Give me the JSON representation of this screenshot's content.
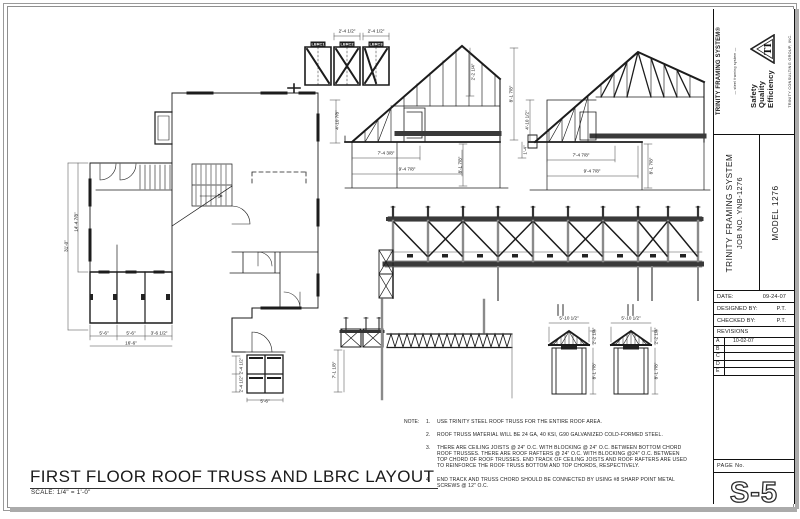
{
  "colors": {
    "line": "#1c1c1c",
    "frame_gray": "#9a9a9a",
    "post_gray": "#8a8a8a"
  },
  "sheet": {
    "title": "FIRST FLOOR ROOF TRUSS AND LBRC LAYOUT",
    "scale": "SCALE:  1/4\" =  1'-0\""
  },
  "title_block": {
    "brand": "TRINITY FRAMING SYSTEM®",
    "brand_tagline": "— steel framing system —",
    "values": [
      "Safety",
      "Quality",
      "Efficiency"
    ],
    "monogram": "TI",
    "company": "TRINITY CONSULTING GROUP, INC.",
    "project": {
      "line1": "TRINITY FRAMING SYSTEM",
      "line2": "JOB NO. YNB-1276",
      "model": "MODEL  1276"
    },
    "date_label": "DATE:",
    "date_value": "09-24-07",
    "designed_label": "DESIGNED BY:",
    "designed_value": "P.T.",
    "checked_label": "CHECKED BY:",
    "checked_value": "P.T.",
    "revisions_label": "REVISIONS",
    "revisions": [
      {
        "row": "A",
        "date": "10-02-07"
      },
      {
        "row": "B",
        "date": ""
      },
      {
        "row": "C",
        "date": ""
      },
      {
        "row": "D",
        "date": ""
      },
      {
        "row": "E",
        "date": ""
      }
    ],
    "page_label": "PAGE  No.",
    "page_number": "S-5"
  },
  "notes": {
    "heading": "NOTE:",
    "items": [
      {
        "num": "1.",
        "text": "USE TRINITY STEEL ROOF TRUSS FOR THE ENTIRE ROOF AREA."
      },
      {
        "num": "2.",
        "text": "ROOF TRUSS MATERIAL WILL BE 24 GA, 40 KSI, G90 GALVANIZED COLD-FORMED STEEL."
      },
      {
        "num": "3.",
        "text": "THERE ARE CEILING JOISTS @ 24\" O.C. WITH BLOCKING @ 24\" O.C. BETWEEN BOTTOM CHORD ROOF TRUSSES.  THERE ARE ROOF RAFTERS @ 24\" O.C. WITH BLOCKING @24\" O.C. BETWEEN TOP CHORD OF ROOF TRUSSES.  END TRACK OF CEILING JOISTS AND ROOF RAFTERS ARE USED TO REINFORCE THE ROOF TRUSS BOTTOM AND TOP CHORDS, RESPECTIVELY."
      },
      {
        "num": "4.",
        "text": "END TRACK AND TRUSS CHORD SHOULD BE CONNECTED BY USING #8 SHARP POINT METAL SCREWS @ 12\" O.C."
      }
    ]
  },
  "drawing": {
    "panel_labels": [
      "LBRC1",
      "LBRC2",
      "LBRC3"
    ],
    "labels": [
      {
        "t": "2'-4 1/2\"",
        "x": 347,
        "y": 31
      },
      {
        "t": "2'-4 1/2\"",
        "x": 376,
        "y": 31
      },
      {
        "t": "LBRC1",
        "x": 318,
        "y": 44,
        "inv": 1
      },
      {
        "t": "LBRC2",
        "x": 347,
        "y": 44,
        "inv": 1
      },
      {
        "t": "LBRC3",
        "x": 376,
        "y": 44,
        "inv": 1
      },
      {
        "t": "7'-4 3/8\"",
        "x": 386,
        "y": 153
      },
      {
        "t": "9'-4 7/8\"",
        "x": 407,
        "y": 169
      },
      {
        "t": "2'-2 1/4\"",
        "x": 473,
        "y": 72,
        "rot": 1
      },
      {
        "t": "8'-1 7/8\"",
        "x": 511,
        "y": 94,
        "rot": 1
      },
      {
        "t": "8'-1 7/8\"",
        "x": 460,
        "y": 165,
        "rot": 1
      },
      {
        "t": "7'-4 7/8\"",
        "x": 581,
        "y": 155
      },
      {
        "t": "9'-4 7/8\"",
        "x": 592,
        "y": 171
      },
      {
        "t": "8'-1 7/8\"",
        "x": 651,
        "y": 166,
        "rot": 1
      },
      {
        "t": "4'-10 1/2\"",
        "x": 527,
        "y": 120,
        "rot": 1
      },
      {
        "t": "1'-4\"",
        "x": 525,
        "y": 150,
        "rot": 1
      },
      {
        "t": "5'-10 1/2\"",
        "x": 569,
        "y": 318
      },
      {
        "t": "5'-10 1/2\"",
        "x": 631,
        "y": 318
      },
      {
        "t": "2'-2 1/4\"",
        "x": 594,
        "y": 336,
        "rot": 1
      },
      {
        "t": "8'-1 7/8\"",
        "x": 594,
        "y": 371,
        "rot": 1
      },
      {
        "t": "2'-2 1/4\"",
        "x": 656,
        "y": 336,
        "rot": 1
      },
      {
        "t": "8'-1 7/8\"",
        "x": 656,
        "y": 371,
        "rot": 1
      },
      {
        "t": "7'-1 1/8\"",
        "x": 334,
        "y": 370,
        "rot": 1
      },
      {
        "t": "31'-0\"",
        "x": 66,
        "y": 246,
        "rot": 1
      },
      {
        "t": "14'-4 7/8\"",
        "x": 76,
        "y": 222,
        "rot": 1
      },
      {
        "t": "5'-6\"",
        "x": 104,
        "y": 333
      },
      {
        "t": "5'-6\"",
        "x": 131,
        "y": 333
      },
      {
        "t": "3'-6 1/2\"",
        "x": 159,
        "y": 333
      },
      {
        "t": "16'-6\"",
        "x": 131,
        "y": 343
      },
      {
        "t": "5'-6\"",
        "x": 265,
        "y": 401
      },
      {
        "t": "4'-10 7/8\"",
        "x": 337,
        "y": 120,
        "rot": 1
      },
      {
        "t": "2'-4 1/2\"",
        "x": 241,
        "y": 366,
        "rot": 1
      },
      {
        "t": "2'-4 1/2\"",
        "x": 241,
        "y": 384,
        "rot": 1
      }
    ]
  }
}
